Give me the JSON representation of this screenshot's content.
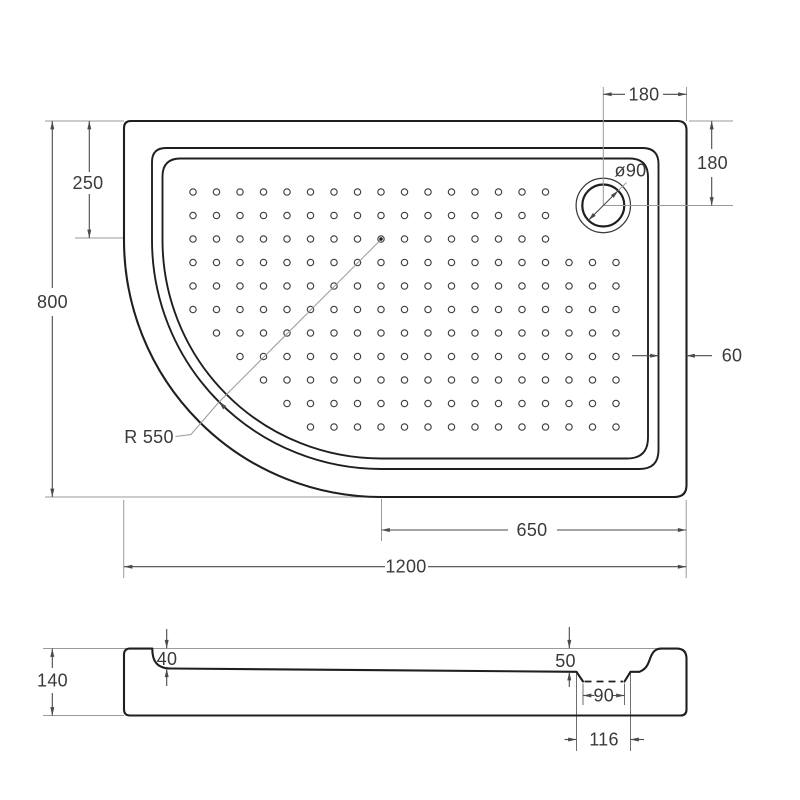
{
  "colors": {
    "outline": "#1f1f1f",
    "dimension": "#4a4a4a",
    "extension": "#9a9a9a",
    "extension_dark": "#6e6e6e",
    "dot": "#3f3f3f",
    "text": "#3a3a3a",
    "background": "#ffffff"
  },
  "top_view": {
    "width_label": "1200",
    "height_label": "800",
    "top_offset_label": "250",
    "drain_offset_top_label": "180",
    "drain_offset_side_label": "180",
    "drain_diameter_label": "ø90",
    "corner_radius_label": "R 550",
    "wall_offset_label": "60",
    "drain_center_offset_label": "650"
  },
  "section_view": {
    "height_label": "140",
    "depth_left_label": "40",
    "depth_right_label": "50",
    "drain_hole_label": "90",
    "drain_recess_label": "116"
  },
  "dot_pattern": {
    "origin_x": 193,
    "origin_y": 192,
    "spacing": 23.5,
    "radius": 3.2,
    "rows": [
      {
        "row": 0,
        "from": 0,
        "to": 15
      },
      {
        "row": 1,
        "from": 0,
        "to": 15
      },
      {
        "row": 2,
        "from": 0,
        "to": 15
      },
      {
        "row": 3,
        "from": 0,
        "to": 18
      },
      {
        "row": 4,
        "from": 0,
        "to": 18
      },
      {
        "row": 5,
        "from": 0,
        "to": 18
      },
      {
        "row": 6,
        "from": 1,
        "to": 18
      },
      {
        "row": 7,
        "from": 2,
        "to": 18
      },
      {
        "row": 8,
        "from": 3,
        "to": 18
      },
      {
        "row": 9,
        "from": 4,
        "to": 18
      },
      {
        "row": 10,
        "from": 5,
        "to": 18
      }
    ],
    "center_marker": {
      "col": 8,
      "row": 2
    }
  }
}
